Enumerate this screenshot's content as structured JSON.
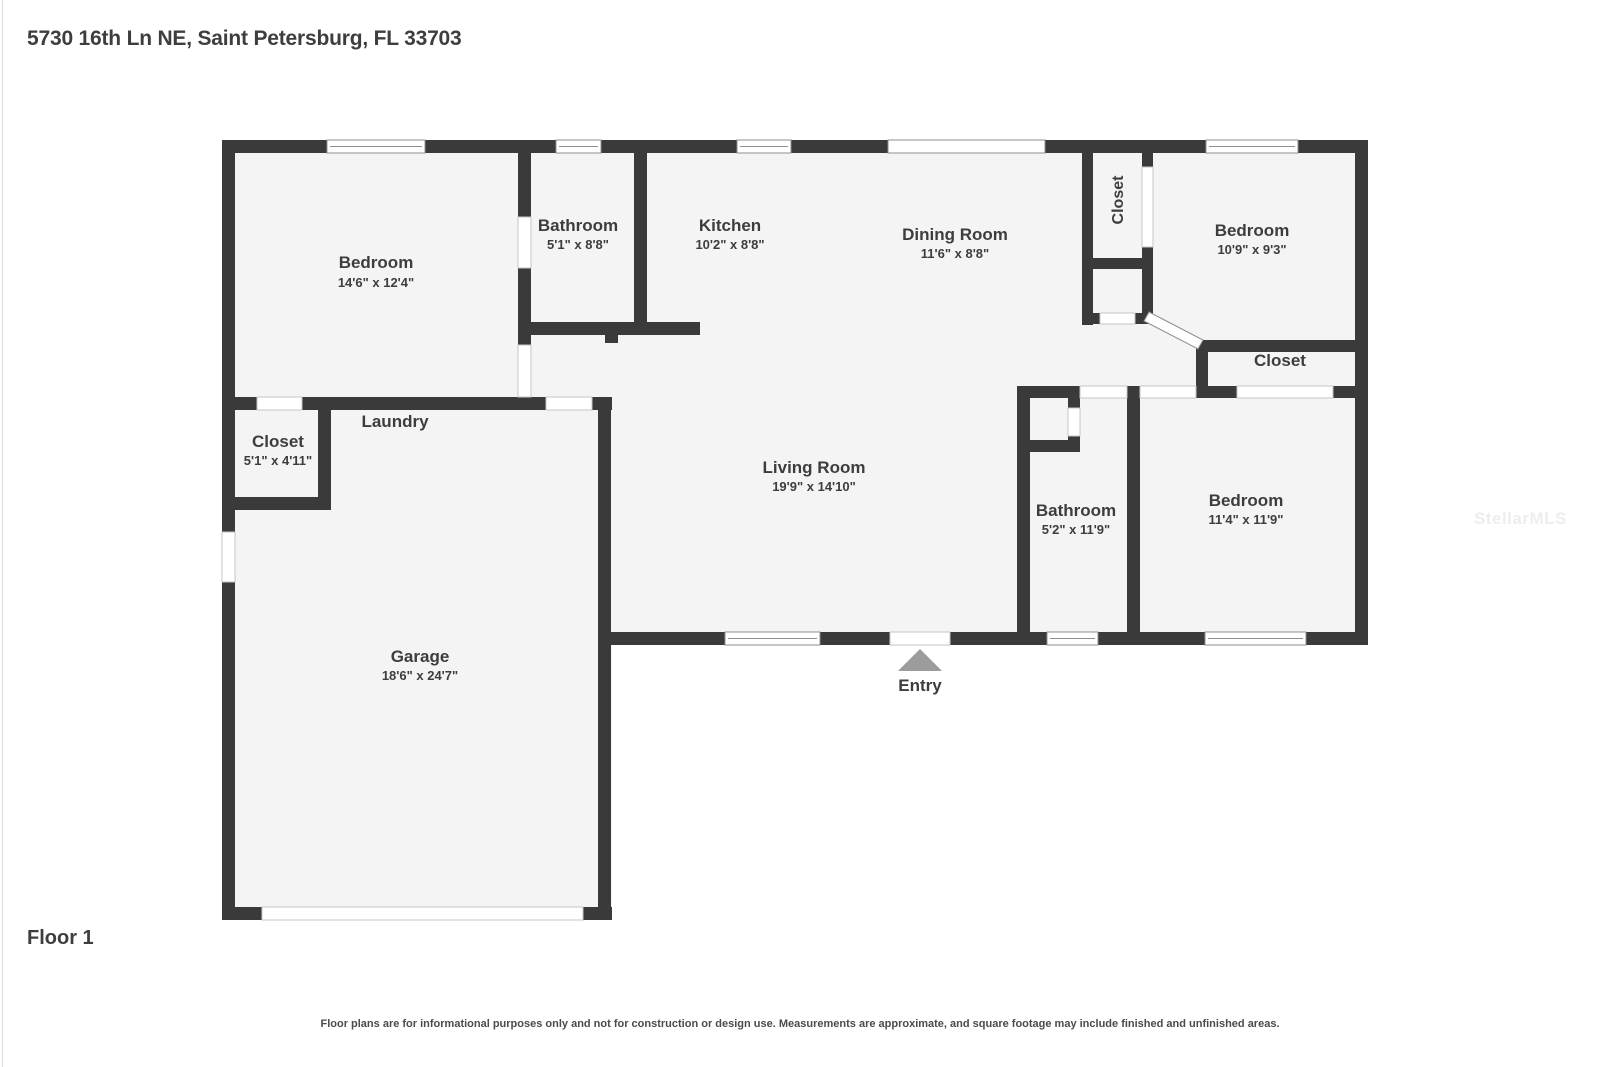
{
  "header": {
    "address": "5730 16th Ln NE, Saint Petersburg, FL 33703"
  },
  "floor_plan": {
    "rooms": [
      {
        "id": "bedroom-1",
        "name": "Bedroom",
        "dims": "14'6\" x 12'4\""
      },
      {
        "id": "bathroom-1",
        "name": "Bathroom",
        "dims": "5'1\" x 8'8\""
      },
      {
        "id": "kitchen",
        "name": "Kitchen",
        "dims": "10'2\" x 8'8\""
      },
      {
        "id": "dining-room",
        "name": "Dining Room",
        "dims": "11'6\" x 8'8\""
      },
      {
        "id": "closet-hall",
        "name": "Closet",
        "dims": ""
      },
      {
        "id": "bedroom-2",
        "name": "Bedroom",
        "dims": "10'9\" x 9'3\""
      },
      {
        "id": "closet-bedroom-2",
        "name": "Closet",
        "dims": ""
      },
      {
        "id": "living-room",
        "name": "Living Room",
        "dims": "19'9\" x 14'10\""
      },
      {
        "id": "bathroom-2",
        "name": "Bathroom",
        "dims": "5'2\" x 11'9\""
      },
      {
        "id": "bedroom-3",
        "name": "Bedroom",
        "dims": "11'4\" x 11'9\""
      },
      {
        "id": "closet-laundry",
        "name": "Closet",
        "dims": "5'1\" x 4'11\""
      },
      {
        "id": "laundry",
        "name": "Laundry",
        "dims": ""
      },
      {
        "id": "garage",
        "name": "Garage",
        "dims": "18'6\" x 24'7\""
      }
    ],
    "entry_label": "Entry",
    "icons": {
      "entry_arrow": "triangle-up"
    }
  },
  "footer": {
    "floor_label": "Floor 1",
    "disclaimer": "Floor plans are for informational purposes only and not for construction or design use. Measurements are approximate, and square footage may include finished and unfinished areas."
  },
  "watermark": "StellarMLS",
  "colors": {
    "wall": "#3a3a3a",
    "floor": "#f4f4f4",
    "label_text": "#3d3d3d",
    "entry_arrow": "#9c9c9c",
    "watermark": "#ededed"
  }
}
